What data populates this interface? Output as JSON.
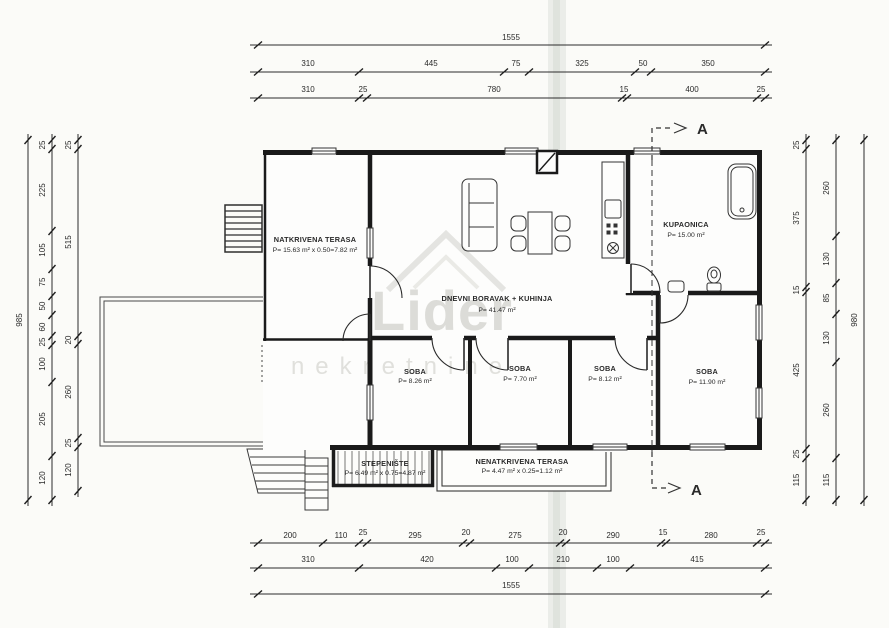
{
  "plan": {
    "watermark": {
      "line1": "Lider",
      "line2": "nekretnine"
    },
    "section_label": "A",
    "rooms": [
      {
        "name": "NATKRIVENA TERASA",
        "area": "P= 15.63 m² x 0.50=7.82 m²"
      },
      {
        "name": "DNEVNI BORAVAK + KUHINJA",
        "area": "P= 41.47 m²"
      },
      {
        "name": "KUPAONICA",
        "area": "P= 15.00 m²"
      },
      {
        "name": "SOBA",
        "area": "P= 8.26 m²"
      },
      {
        "name": "SOBA",
        "area": "P= 7.70 m²"
      },
      {
        "name": "SOBA",
        "area": "P= 8.12 m²"
      },
      {
        "name": "SOBA",
        "area": "P= 11.90 m²"
      },
      {
        "name": "STEPENIŠTE",
        "area": "P= 6.49 m² x 0.75=4.87 m²"
      },
      {
        "name": "NENATKRIVENA TERASA",
        "area": "P= 4.47 m² x 0.25=1.12 m²"
      }
    ],
    "dims": {
      "top": {
        "total": "1555",
        "row2": [
          "310",
          "445",
          "75",
          "325",
          "50",
          "350"
        ],
        "row3": [
          "310",
          "25",
          "780",
          "15",
          "400",
          "25"
        ]
      },
      "bottom": {
        "row1": [
          "200",
          "110",
          "25",
          "295",
          "20",
          "275",
          "20",
          "290",
          "15",
          "280",
          "25"
        ],
        "row2": [
          "310",
          "420",
          "100",
          "210",
          "100",
          "415"
        ],
        "total": "1555"
      },
      "left": {
        "total": "985",
        "mid": [
          "25",
          "225",
          "105",
          "75",
          "50",
          "60",
          "25",
          "100",
          "205",
          "120"
        ],
        "inner": [
          "25",
          "515",
          "20",
          "260",
          "25",
          "120"
        ]
      },
      "right": {
        "inner": [
          "25",
          "375",
          "15",
          "425",
          "25",
          "115"
        ],
        "mid": [
          "260",
          "130",
          "85",
          "130",
          "260",
          "115"
        ],
        "total": "980"
      }
    }
  }
}
